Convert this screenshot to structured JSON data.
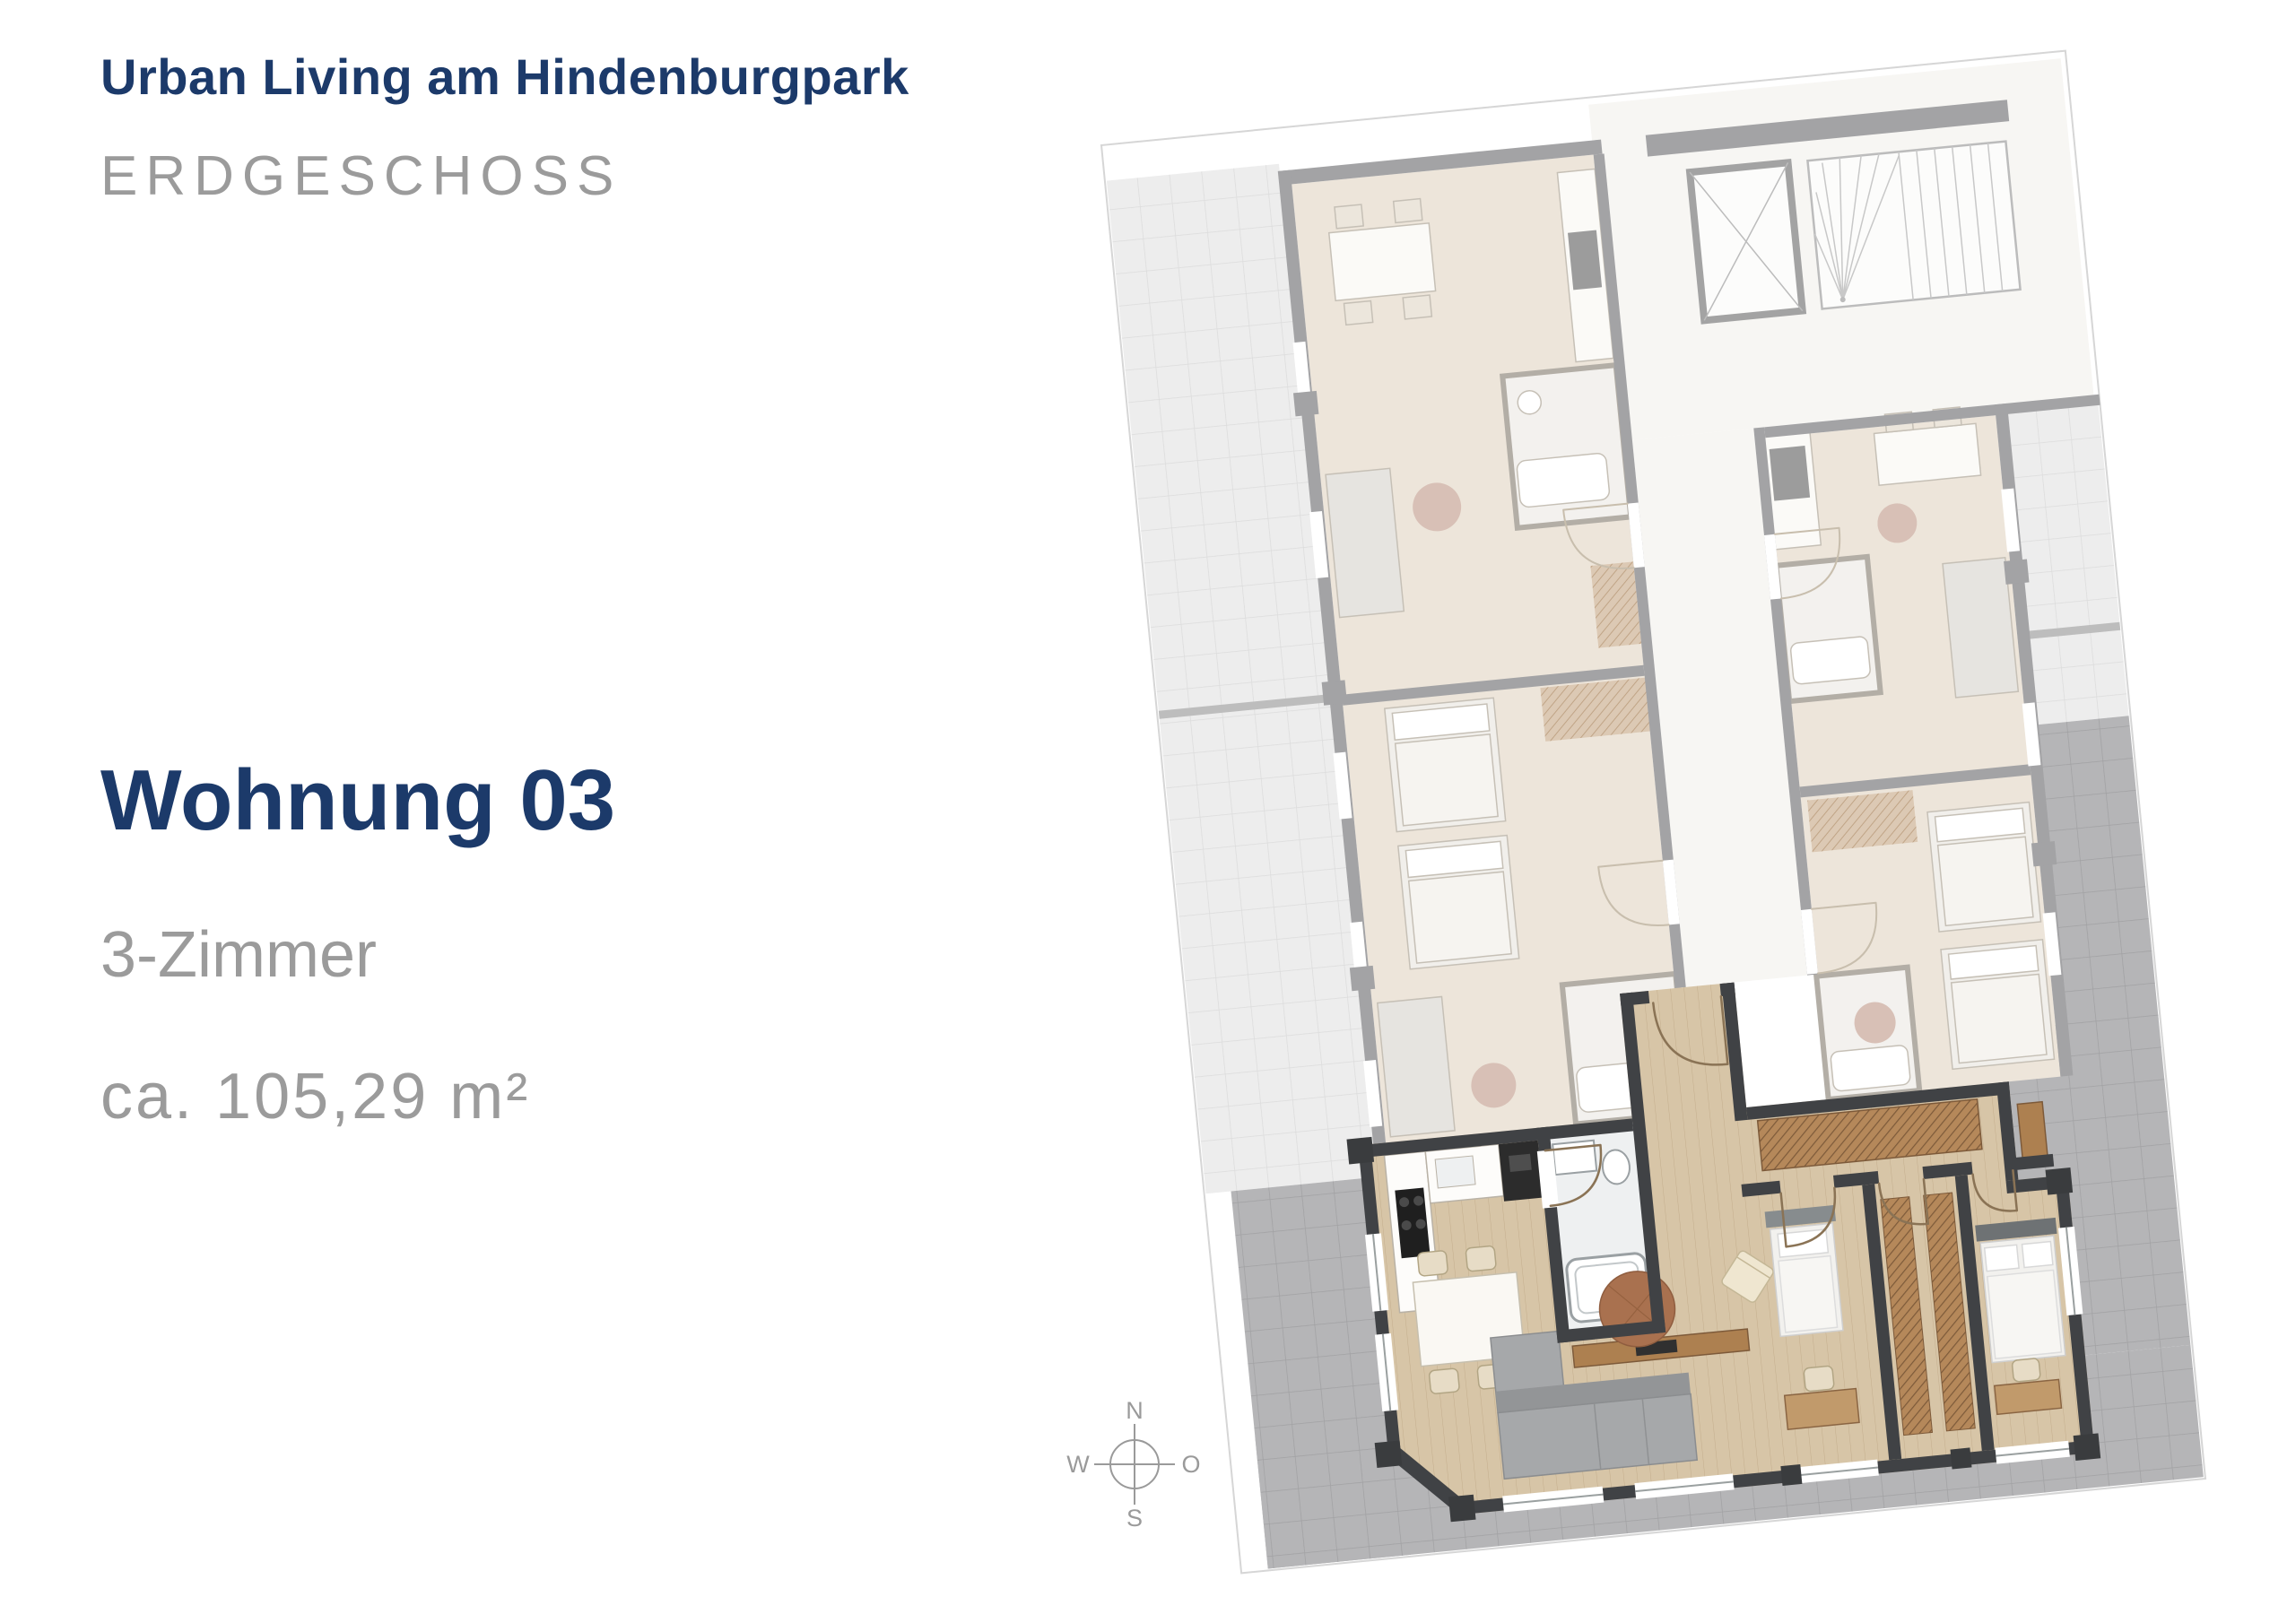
{
  "header": {
    "project_title": "Urban Living am Hindenburgpark",
    "floor_label": "ERDGESCHOSS"
  },
  "unit": {
    "name": "Wohnung 03",
    "rooms": "3-Zimmer",
    "area": "ca. 105,29 m²"
  },
  "compass": {
    "north": "N",
    "east": "O",
    "south": "S",
    "west": "W"
  },
  "plan": {
    "highlighted_unit": "Wohnung 03",
    "icons": {
      "compass_icon": "compass-rose-circle-cross",
      "elevator_icon": "box-with-x-cross",
      "stairs_icon": "treads-with-fan-lines",
      "door_icon": "quarter-arc-swing",
      "tree_icon": "round-planter-circle"
    }
  },
  "colors": {
    "brand_navy": "#1c3a6a",
    "muted_text": "#9b9b9b",
    "sheet_border": "#d6d6d6",
    "wall_dark": "#404245",
    "wall_faded": "#a3a3a5",
    "wood_floor": "#d7c5a7",
    "wood_floor_faded": "#ede5da",
    "marble": "#f7f6f3",
    "terrace_light": "#ededed",
    "terrace_light_line": "#dcdcdc",
    "terrace_dark": "#b5b5b7",
    "terrace_dark_line": "#a1a1a3",
    "furniture_brown": "#b5885a",
    "furniture_brown_dark": "#7d5a3a",
    "rug_brown": "#a9714f",
    "sofa_gray": "#a6a8aa",
    "compass_gray": "#9a9a9a",
    "appliance_black": "#1f1f1f",
    "chair_beige": "#e7dcc6",
    "bath_tile": "#eef0f1"
  }
}
